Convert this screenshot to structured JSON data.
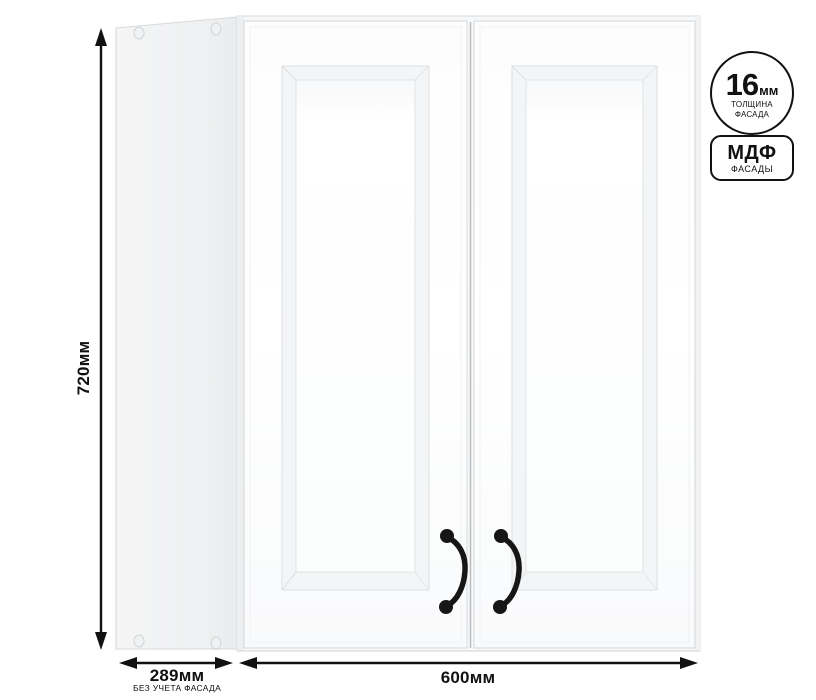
{
  "palette": {
    "outline_black": "#111111",
    "cabinet_white": "#ffffff",
    "side_panel_gray": "#edeef0",
    "edge_gray": "#d6d8da",
    "handle_black": "#161616"
  },
  "dimensions": {
    "height": {
      "value": "720мм"
    },
    "depth": {
      "value": "289мм",
      "note": "БЕЗ УЧЕТА ФАСАДА"
    },
    "width": {
      "value": "600мм"
    }
  },
  "badges": {
    "thickness": {
      "value": "16",
      "unit": "мм",
      "line1": "ТОЛЩИНА",
      "line2": "ФАСАДА"
    },
    "material": {
      "title": "МДФ",
      "subtitle": "ФАСАДЫ"
    }
  }
}
